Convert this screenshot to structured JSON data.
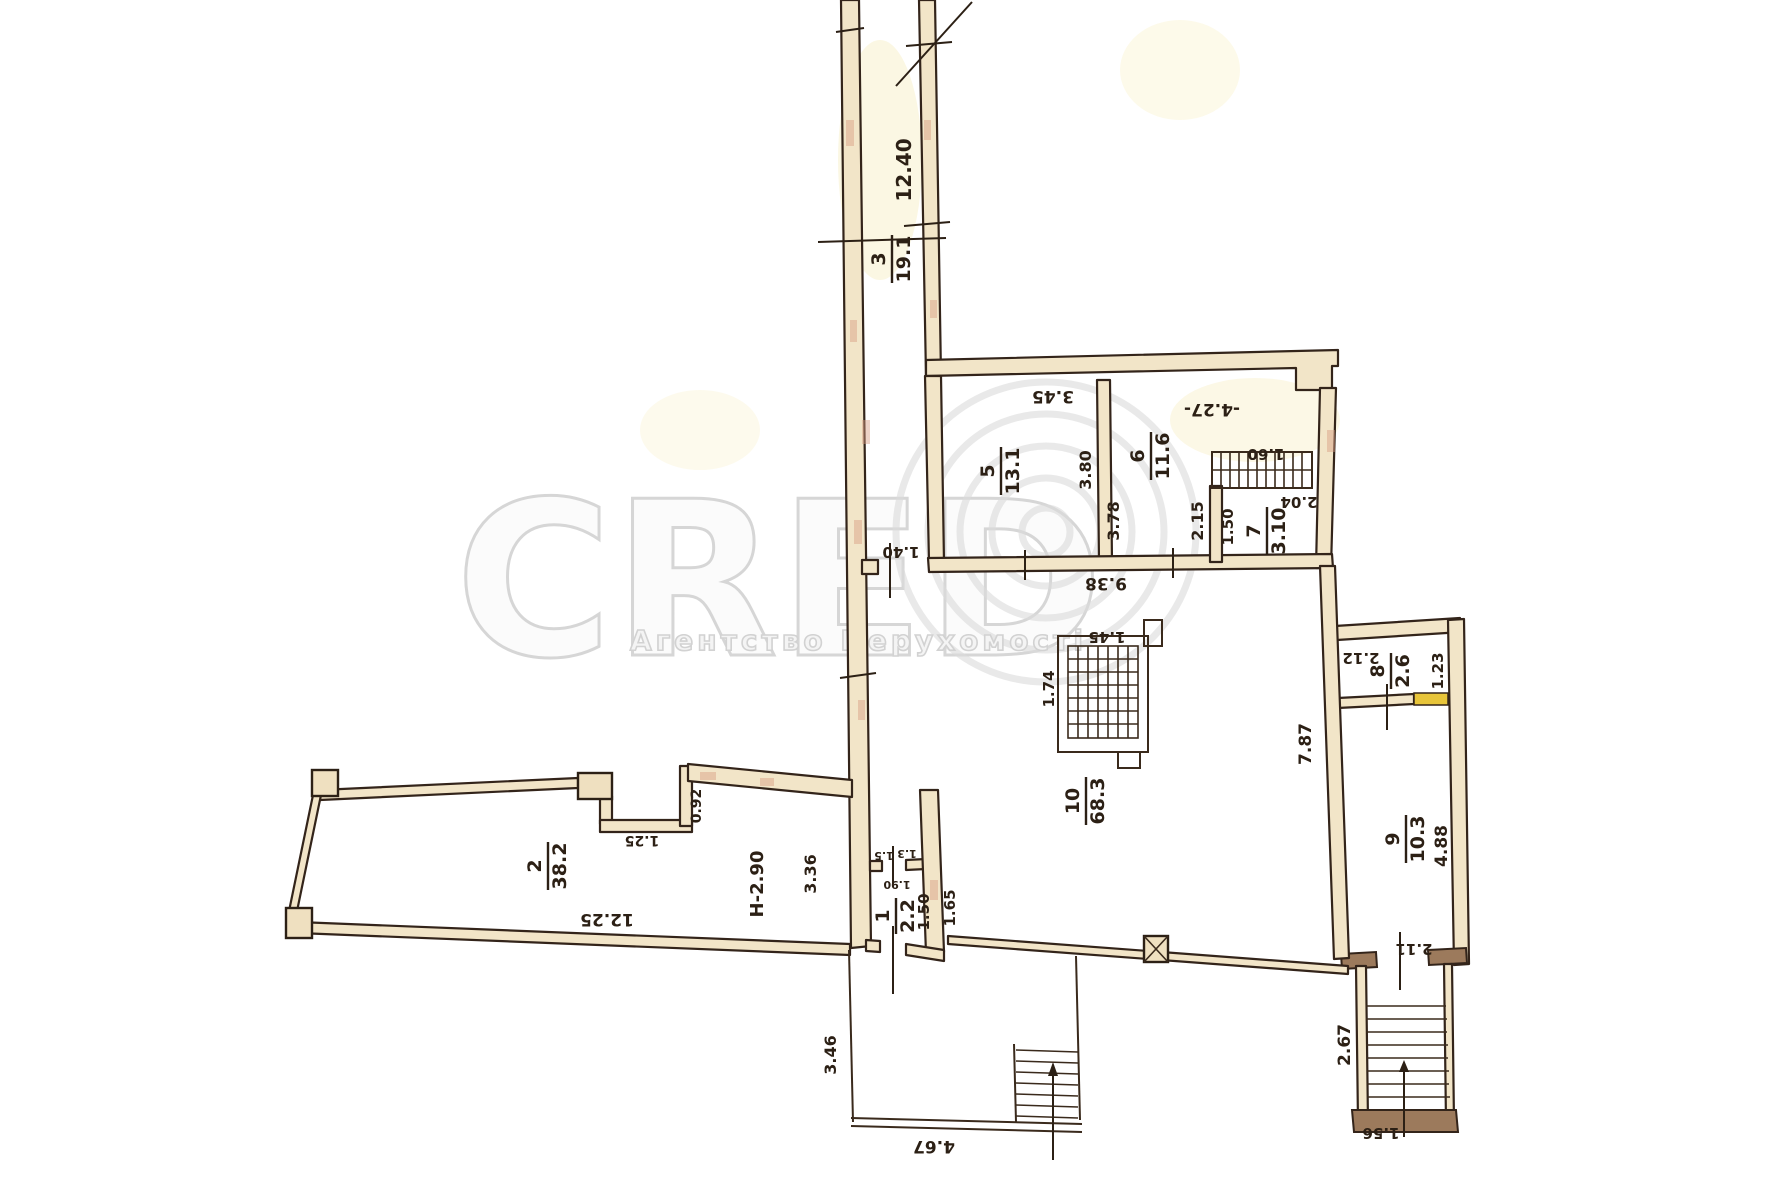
{
  "watermark": {
    "brand": "CRED",
    "subtitle": "Агентство Нерухомості",
    "color": "#d8d8d8"
  },
  "plan": {
    "height_note": "H-2.90",
    "ink_color": "#33241a",
    "wall_fill": "#f2e5c8",
    "door_highlight": "#e8c53a",
    "rooms": [
      {
        "number": "1",
        "area": "2.2",
        "x": 896,
        "y": 916,
        "rot": -90
      },
      {
        "number": "2",
        "area": "38.2",
        "x": 548,
        "y": 866,
        "rot": -90
      },
      {
        "number": "3",
        "area": "19.1",
        "x": 892,
        "y": 259,
        "rot": -90
      },
      {
        "number": "5",
        "area": "13.1",
        "x": 1001,
        "y": 471,
        "rot": -90
      },
      {
        "number": "6",
        "area": "11.6",
        "x": 1151,
        "y": 456,
        "rot": -90
      },
      {
        "number": "7",
        "area": "3.10",
        "x": 1267,
        "y": 531,
        "rot": -90
      },
      {
        "number": "8",
        "area": "2.6",
        "x": 1391,
        "y": 671,
        "rot": -90
      },
      {
        "number": "9",
        "area": "10.3",
        "x": 1406,
        "y": 839,
        "rot": -90
      },
      {
        "number": "10",
        "area": "68.3",
        "x": 1086,
        "y": 801,
        "rot": -90
      }
    ],
    "dimensions": [
      {
        "text": "12.40",
        "x": 911,
        "y": 170,
        "rot": -90,
        "size": 20
      },
      {
        "text": "3.45",
        "x": 1053,
        "y": 391,
        "rot": 180,
        "size": 17
      },
      {
        "text": "-4.27-",
        "x": 1212,
        "y": 404,
        "rot": 180,
        "size": 17
      },
      {
        "text": "3.80",
        "x": 1091,
        "y": 470,
        "rot": -90,
        "size": 16
      },
      {
        "text": "3.78",
        "x": 1119,
        "y": 521,
        "rot": -90,
        "size": 16
      },
      {
        "text": "2.15",
        "x": 1203,
        "y": 521,
        "rot": -90,
        "size": 16
      },
      {
        "text": "1.60",
        "x": 1266,
        "y": 449,
        "rot": 180,
        "size": 15
      },
      {
        "text": "2.04",
        "x": 1299,
        "y": 497,
        "rot": 180,
        "size": 15
      },
      {
        "text": "1.50",
        "x": 1233,
        "y": 527,
        "rot": -90,
        "size": 15
      },
      {
        "text": "9.38",
        "x": 1106,
        "y": 578,
        "rot": 180,
        "size": 17
      },
      {
        "text": "1.40",
        "x": 901,
        "y": 547,
        "rot": 180,
        "size": 15
      },
      {
        "text": "1.45",
        "x": 1107,
        "y": 632,
        "rot": 180,
        "size": 15
      },
      {
        "text": "1.74",
        "x": 1054,
        "y": 689,
        "rot": -90,
        "size": 15
      },
      {
        "text": "7.87",
        "x": 1311,
        "y": 744,
        "rot": -90,
        "size": 17
      },
      {
        "text": "2.12",
        "x": 1361,
        "y": 653,
        "rot": 180,
        "size": 15
      },
      {
        "text": "1.23",
        "x": 1443,
        "y": 671,
        "rot": -90,
        "size": 15
      },
      {
        "text": "4.88",
        "x": 1447,
        "y": 846,
        "rot": -90,
        "size": 17
      },
      {
        "text": "2.11",
        "x": 1414,
        "y": 944,
        "rot": 180,
        "size": 15
      },
      {
        "text": "2.67",
        "x": 1350,
        "y": 1045,
        "rot": -90,
        "size": 17
      },
      {
        "text": "1.56",
        "x": 1381,
        "y": 1128,
        "rot": 180,
        "size": 15
      },
      {
        "text": "12.25",
        "x": 607,
        "y": 914,
        "rot": 180,
        "size": 17
      },
      {
        "text": "0.92",
        "x": 701,
        "y": 806,
        "rot": -90,
        "size": 14
      },
      {
        "text": "1.25",
        "x": 642,
        "y": 836,
        "rot": 180,
        "size": 14
      },
      {
        "text": "H-2.90",
        "x": 763,
        "y": 884,
        "rot": -90,
        "size": 18
      },
      {
        "text": "3.36",
        "x": 816,
        "y": 874,
        "rot": -90,
        "size": 16
      },
      {
        "text": "1.50",
        "x": 929,
        "y": 912,
        "rot": -90,
        "size": 15
      },
      {
        "text": "1.65",
        "x": 955,
        "y": 908,
        "rot": -90,
        "size": 15
      },
      {
        "text": "1.5",
        "x": 884,
        "y": 852,
        "rot": 180,
        "size": 11
      },
      {
        "text": "1.3",
        "x": 907,
        "y": 850,
        "rot": 180,
        "size": 11
      },
      {
        "text": "1.90",
        "x": 897,
        "y": 881,
        "rot": 180,
        "size": 11
      },
      {
        "text": "3.46",
        "x": 836,
        "y": 1055,
        "rot": -90,
        "size": 16
      },
      {
        "text": "4.67",
        "x": 934,
        "y": 1141,
        "rot": 180,
        "size": 17
      }
    ]
  }
}
